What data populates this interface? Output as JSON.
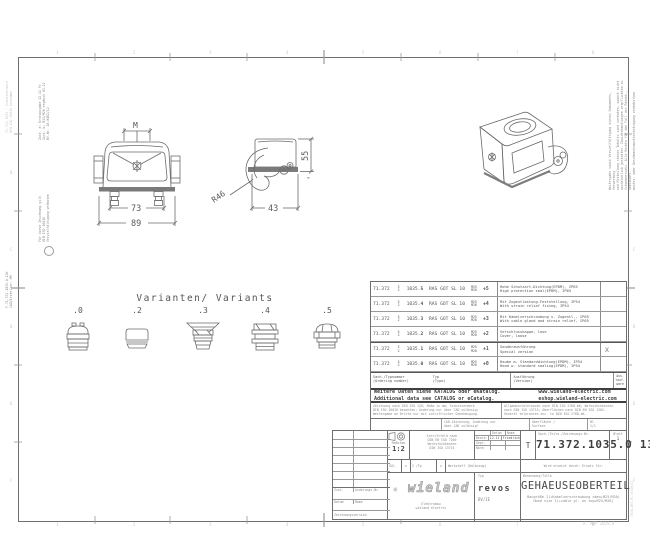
{
  "doc": {
    "footer_note": "A. MKP 2019.8"
  },
  "views": {
    "front": {
      "m": "M",
      "w_inner": "73",
      "w_outer": "89"
    },
    "side": {
      "r": "R46",
      "w": "43",
      "h": "55",
      "approx": "≈"
    }
  },
  "variants": {
    "title": "Varianten/ Variants",
    "labels": [
      ".0",
      ".2",
      ".3",
      ".4",
      ".5"
    ]
  },
  "table": {
    "pn_prefix": "71.372",
    "pn_sup": "5",
    "pn_sub": "2",
    "pn_base": "1035.",
    "m_top": "M25",
    "m_bot": "M20",
    "rows": [
      {
        "v": "5",
        "type": "RAS GOT SL 10",
        "plus": "+5",
        "de": "Hohe Schutzart-Dichtung(EPDM), IP65",
        "en": "High protection seal(EPDM), IP65",
        "x": ""
      },
      {
        "v": "4",
        "type": "RAS GOT SL 10",
        "plus": "+4",
        "de": "Mit Zugentlastung-Feststellung, IP54",
        "en": "With strain relief fixing, IP54",
        "x": ""
      },
      {
        "v": "3",
        "type": "RAS GOT SL 10",
        "plus": "+3",
        "de": "Mit Kabelverschraubung u. Zugentl., IP65",
        "en": "With cable gland and strain relief, IP65",
        "x": ""
      },
      {
        "v": "2",
        "type": "RAS GOT SL 10",
        "plus": "+2",
        "de": "Verschlusskappe, lose",
        "en": "Cover, loose",
        "x": ""
      },
      {
        "v": "1",
        "type": "RAS GOT SL 10",
        "plus": "+1",
        "de": "Sonderausführung",
        "en": "Special version",
        "x": "X"
      },
      {
        "v": "0",
        "type": "RAS GOT SL 10",
        "plus": "+0",
        "de": "Haube m. Standarddichtung(EPDM), IP54",
        "en": "Hood w. standard sealing(EPDM), IP54",
        "x": ""
      }
    ],
    "header": {
      "c1a": "Sach-/Typnummer",
      "c1b": "(Ordering number)",
      "c2a": "Typ",
      "c2b": "(Type)",
      "c3a": "Ausführung",
      "c3b": "(Version)",
      "c4a": "Aus-",
      "c4b": "lauf-",
      "c4c": "ware"
    }
  },
  "catalog": {
    "de": "Weitere Daten siehe KATALOG oder eKatalog.",
    "en": "Additional data see CATALOG or eCatalog.",
    "url1": "www.wieland-electric.com",
    "url2": "eshop.wieland-electric.com"
  },
  "notes": {
    "l1": "Zeichnung nach DIN ISO 128; Maße in mm; Schutzvermerk",
    "l2": "DIN ISO 16016 beachten; Änderung nur über CAD zulässig;",
    "l3": "Weitergabe an Dritte nur mit schriftlicher Genehmigung.",
    "r1": "Allgemeintoleranzen nach DIN ISO 2768-mK; Werkstückkanten",
    "r2": "nach DIN ISO 13715; Oberflächen nach DIN EN ISO 1302.",
    "r3": "General tolerances acc. to DIN ISO 2768-mK.",
    "cad1": "CAD-Zeichnung, Änderung nur",
    "cad2": "über CAD zulässig!",
    "surf1": "Oberfläche /",
    "surf2": "Surface",
    "sheet1": "Bl.",
    "sheet2": "1/1"
  },
  "titleblock": {
    "scale_label": "Maßstab",
    "scale": "1:2",
    "std1": "Schriftfeld nach",
    "std2": "DIN EN ISO 7200",
    "std3": "Werkstückkanten",
    "std4": "DIN ISO 13715",
    "appr_h1": "Datum",
    "appr_h2": "Name",
    "r1l": "Bearb.",
    "r1d": "12.11",
    "r1n": "Friedrich",
    "r2l": "Gepr.",
    "r2d": "",
    "r2n": "",
    "r3l": "Norm",
    "r3d": "",
    "r3n": "",
    "t": "T",
    "pn_label": "Sach-/Teile-/Zeichnungs-Nr.",
    "part_number": "71.372.1035.0 13K",
    "sheet_label": "Blatt",
    "sheet_no": "1",
    "replaced": "Wird ersetzt durch:      Ersatz für:",
    "g1": "Gül.",
    "g2": "x",
    "g3": "2 /Tg",
    "g4": "x",
    "g5": "Werkstoff (Halbzeug)",
    "brand": "wieland",
    "brand_icon": "✳",
    "brand_sub1": "Elektrobau",
    "brand_sub2": "wieland electric",
    "series_label": "Typ",
    "series": "revos",
    "series_sub": "BV/IE",
    "title_label": "Benennung/Title",
    "title": "GEHAEUSEOBERTEIL",
    "sub_de": "Baugröße 1(+Kabelverschraubung oben+M25/M20)",
    "sub_en": "Hood size 1(+cable gl. on top+M25/M20)",
    "rev_c1": "Zust.",
    "rev_c2": "Änderungs-Nr.",
    "rev_c3": "Datum",
    "rev_c4": "Name",
    "rev_bottom": "Zeichnungsversion"
  },
  "margins": {
    "left_outer1": "71.372.1035 · Schutzvermerk",
    "left_outer2": "DIN ISO 16016 beachten",
    "left_b1a": "Zust. a: Erstausgabe 12.11 Fr",
    "left_b1b": "Zust. b: M25/M20 ergänzt 03.12",
    "left_b1c": "BV-Nr. 10-0482/12",
    "left_b2a": "Für diese Zeichnung gilt",
    "left_b2b": "DIN ISO 16016",
    "left_b2c": "Vervielfältigung verboten",
    "left_bottom1": "F-71.372.1035.0-13K",
    "left_bottom2": "CAD/Ersteller: MM",
    "right_b1": "Weitergabe sowie Vervielfältigung dieses Dokuments, Verwertung",
    "right_b2": "und Mitteilung seines Inhalts sind verboten, soweit nicht",
    "right_b3": "ausdrücklich gestattet. Zuwiderhandlungen verpflichten zu",
    "right_b4": "Schadenersatz. Alle Rechte für den Fall der Patent-, Gebrauchs-",
    "right_b5": "muster- oder Geschmacksmustereintragung vorbehalten.",
    "right_bottom": "7034-ART-PL-0349/17"
  },
  "grid": {
    "cols": [
      "1",
      "2",
      "3",
      "4",
      "5",
      "6",
      "7",
      "8"
    ],
    "rows": [
      "A",
      "B",
      "C",
      "D",
      "E",
      "F"
    ]
  }
}
